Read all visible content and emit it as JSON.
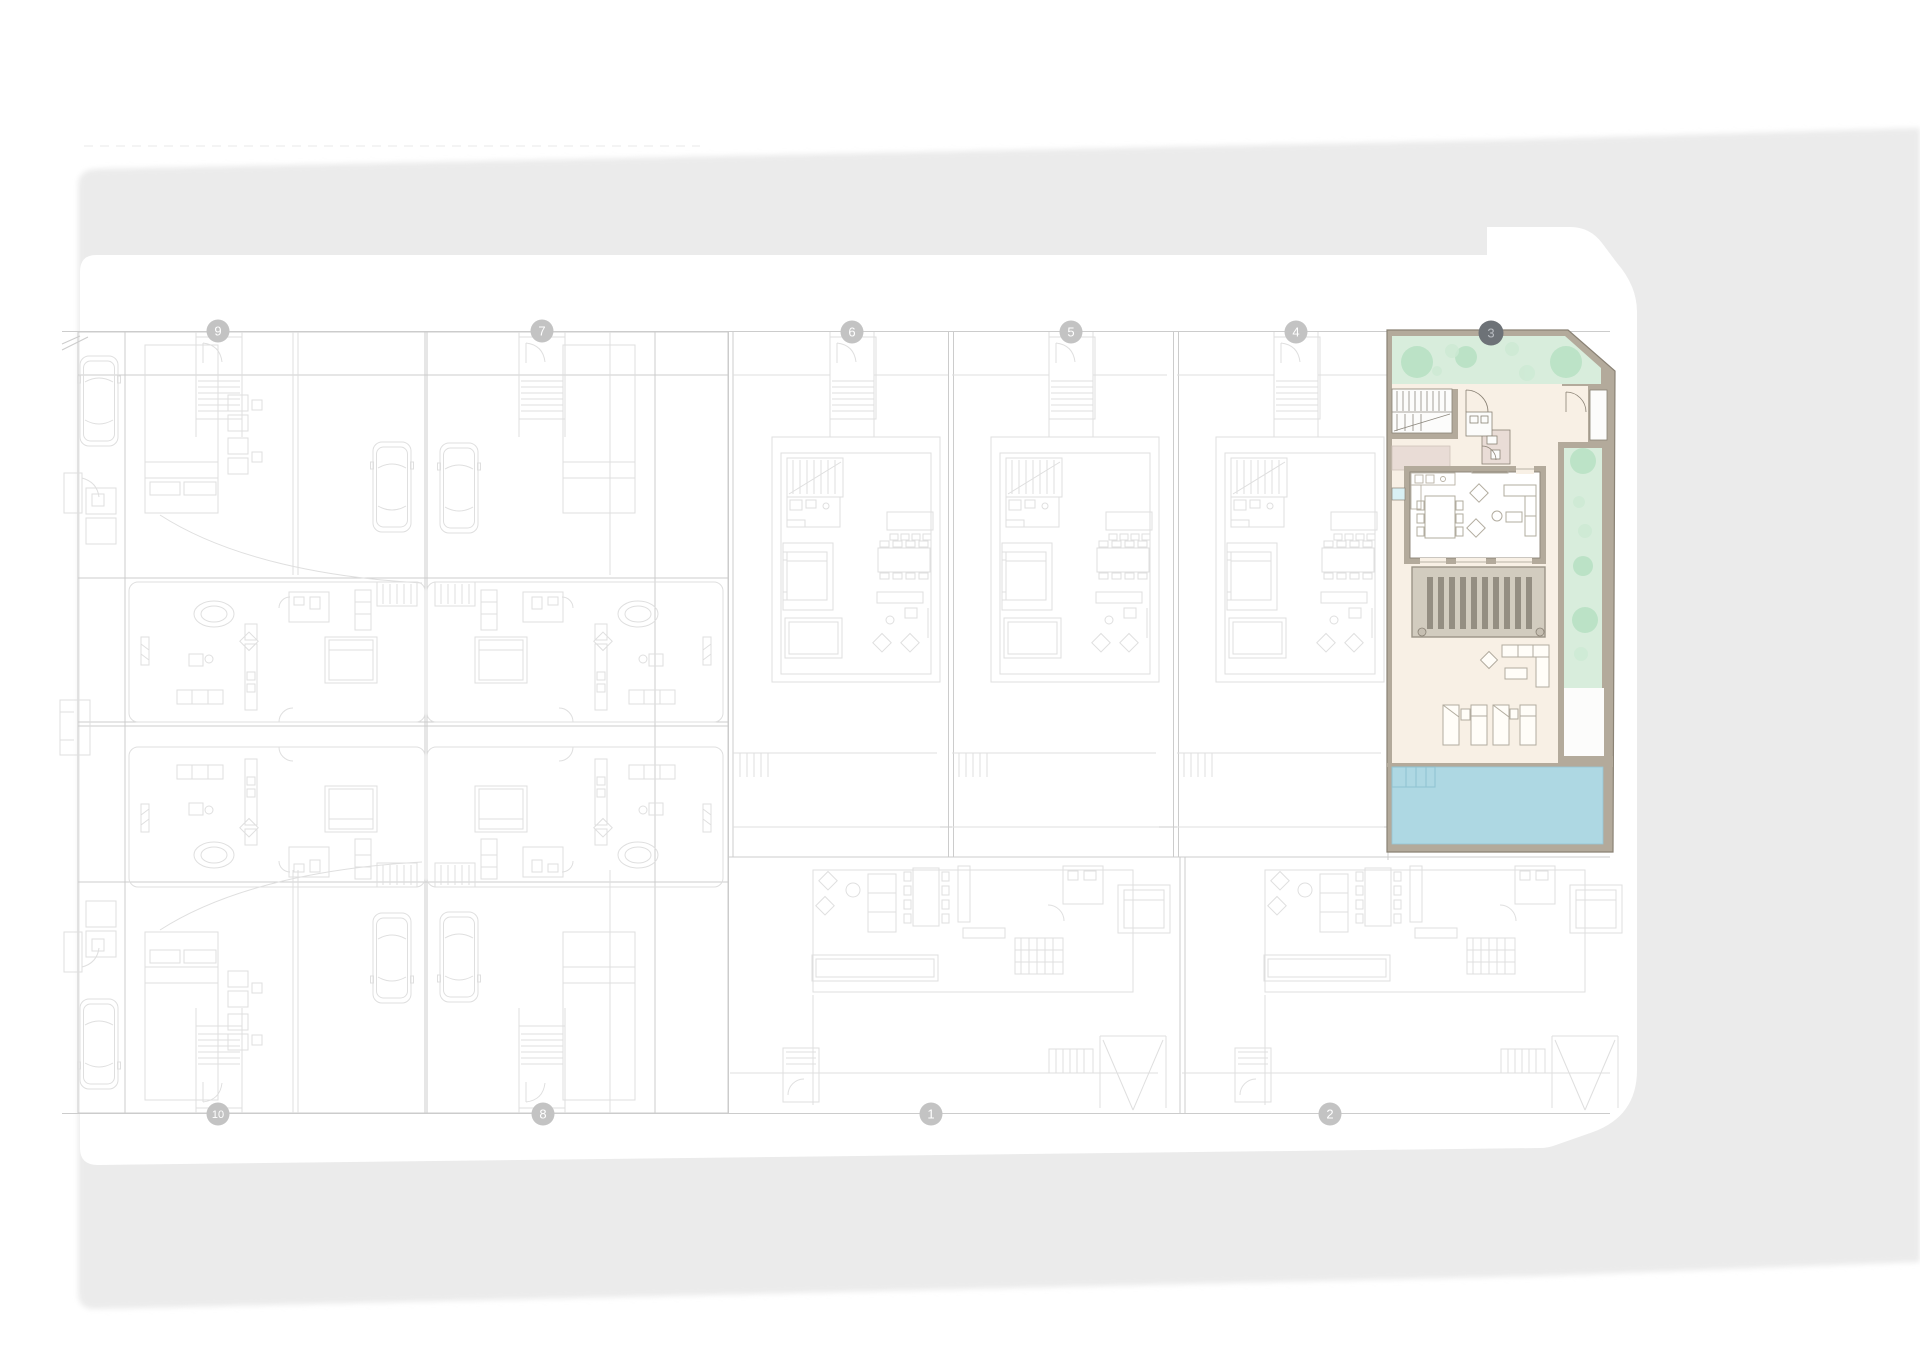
{
  "plan": {
    "selected_plot": "3",
    "plots": {
      "top": [
        {
          "number": "9"
        },
        {
          "number": "7"
        },
        {
          "number": "6"
        },
        {
          "number": "5"
        },
        {
          "number": "4"
        },
        {
          "number": "3"
        }
      ],
      "bottom": [
        {
          "number": "10"
        },
        {
          "number": "8"
        },
        {
          "number": "1"
        },
        {
          "number": "2"
        }
      ]
    }
  },
  "colors": {
    "surface": "#ebebeb",
    "canvas": "#ffffff",
    "line_faint": "#dfdfdf",
    "line_soft": "#cccccc",
    "badge": "#c3c3c3",
    "badge_text": "#ffffff",
    "badge_selected": "#6d7277",
    "badge_selected_text": "#b9bdc2",
    "wall": "#b3aa9b",
    "wall_edge": "#8a8275",
    "interior": "#f8f0e5",
    "room_white": "#fcfcfb",
    "garden": "#d8edDC",
    "tree": "#b7e1c3",
    "tree_soft": "#cdeAD4",
    "pink": "#e9dcd6",
    "deck": "#d2ccbf",
    "slat": "#948e82",
    "pool": "#aed8e3",
    "pool_line": "#8fc2d1",
    "aqua": "#d9f0f4",
    "furniture_line": "#b2ac9f"
  }
}
